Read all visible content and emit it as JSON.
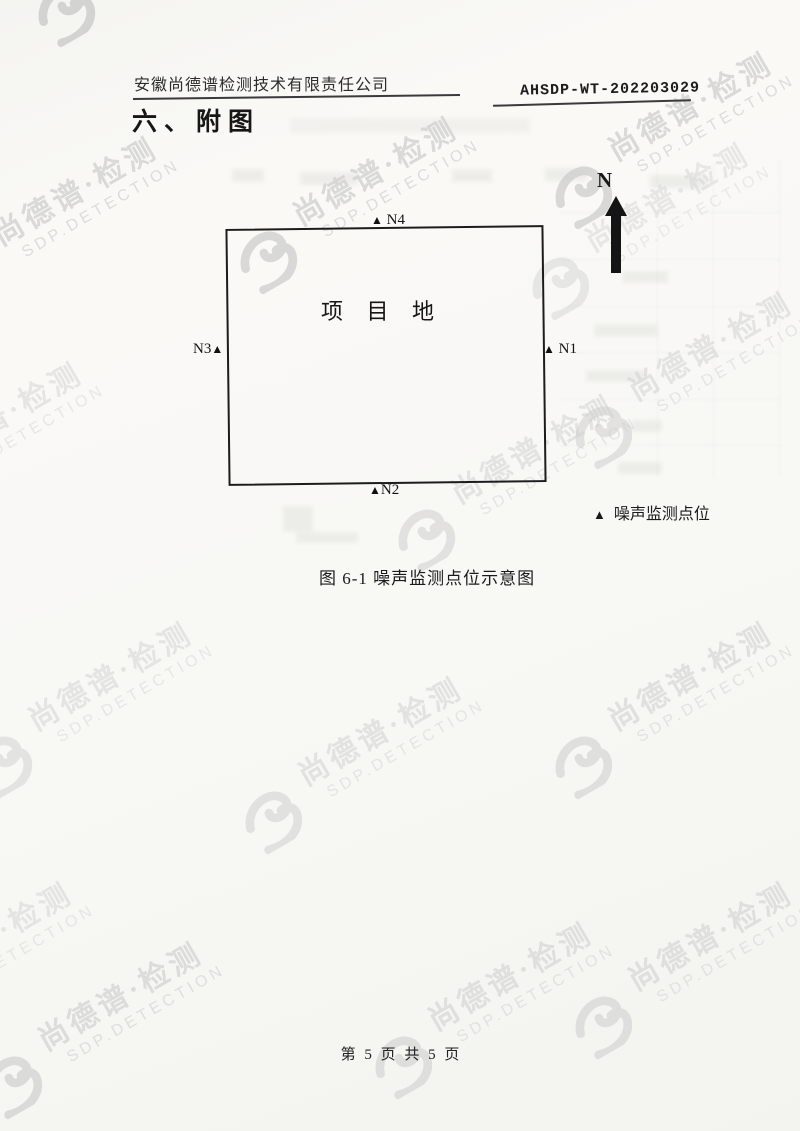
{
  "header": {
    "company": "安徽尚德谱检测技术有限责任公司",
    "report_no": "AHSDP-WT-202203029"
  },
  "section_title": "六、附图",
  "figure": {
    "north_label": "N",
    "site_label": "项 目 地",
    "marker_symbol": "▲",
    "markers": [
      {
        "id": "N4"
      },
      {
        "id": "N1"
      },
      {
        "id": "N3"
      },
      {
        "id": "N2"
      }
    ],
    "legend_symbol": "▲",
    "legend_label": "噪声监测点位",
    "caption": "图 6-1 噪声监测点位示意图"
  },
  "watermark": {
    "zh": "尚德谱·检测",
    "en": "SDP.DETECTION"
  },
  "footer": {
    "page_text": "第 5 页 共 5 页"
  }
}
